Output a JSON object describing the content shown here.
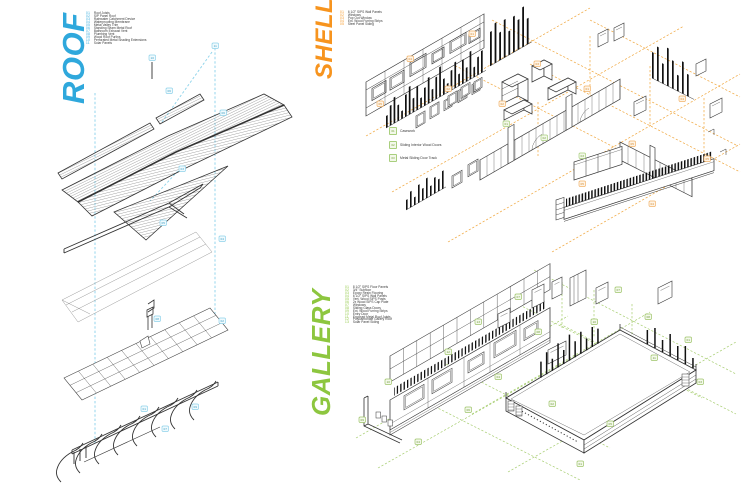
{
  "sections": {
    "roof": {
      "title": "ROOF",
      "legend": [
        {
          "num": "01",
          "label": "Roof Joists"
        },
        {
          "num": "02",
          "label": "SIP Panel Roof"
        },
        {
          "num": "03",
          "label": "Rainwater Catchment Device"
        },
        {
          "num": "04",
          "label": "Waterproofing Membrane"
        },
        {
          "num": "05",
          "label": "Metal Valley Trim"
        },
        {
          "num": "06",
          "label": "Standing Seam Metal Roof"
        },
        {
          "num": "07",
          "label": "Bathroom Exhaust Vent"
        },
        {
          "num": "08",
          "label": "Plumbing Vent"
        },
        {
          "num": "09",
          "label": "Wood Roof Purlins"
        },
        {
          "num": "10",
          "label": "Perforated Metal Shading Extensions"
        },
        {
          "num": "11",
          "label": "Solar Panels"
        }
      ]
    },
    "shell": {
      "title": "SHELL",
      "legend": [
        {
          "num": "01",
          "label": "6 1/2\" SIPS Wall Panels"
        },
        {
          "num": "02",
          "label": "Windows"
        },
        {
          "num": "03",
          "label": "Pop Out Window"
        },
        {
          "num": "04",
          "label": "Ext. Wood Furring Strips"
        },
        {
          "num": "05",
          "label": "Steel Panel Siding"
        }
      ],
      "sub_legend": [
        {
          "num": "01",
          "label": "Casework"
        },
        {
          "num": "02",
          "label": "Sliding Interior Wood Doors"
        },
        {
          "num": "03",
          "label": "Metal Sliding Door Track"
        }
      ]
    },
    "gallery": {
      "title": "GALLERY",
      "legend": [
        {
          "num": "01",
          "label": "8 1/2\" SIPS Floor Panels"
        },
        {
          "num": "02",
          "label": "3/4\" Subfloor"
        },
        {
          "num": "03",
          "label": "Epoxy Resin Flooring"
        },
        {
          "num": "04",
          "label": "6 1/2\" SIPS Wall Panels"
        },
        {
          "num": "05",
          "label": "Vert. Wood SIPS Posts"
        },
        {
          "num": "06",
          "label": "2x Wood SIPS Cap Plate"
        },
        {
          "num": "07",
          "label": "Windows"
        },
        {
          "num": "08",
          "label": "Sliding Glass Doors"
        },
        {
          "num": "09",
          "label": "Ext. Wood Furring Strips"
        },
        {
          "num": "10",
          "label": "Entry Door"
        },
        {
          "num": "11",
          "label": "Exposed Metal Roof Joists"
        },
        {
          "num": "12",
          "label": "Polycarbonate Gallery Roof"
        },
        {
          "num": "13",
          "label": "Solar Panel Siding"
        }
      ]
    }
  },
  "colors": {
    "roof_accent": "#2FA8DC",
    "shell_accent": "#F7941E",
    "gallery_accent": "#8DC63F",
    "ink": "#3A3A3A",
    "line": "#333333",
    "roof_dash": "#8AD2EA",
    "shell_dash": "#F0A63C",
    "gallery_dash": "#A6CD6F",
    "roof_callout": {
      "stroke": "#8FD2EA",
      "fill": "#F0FAFD",
      "text": "#3F9EC4"
    },
    "shell_callout": {
      "stroke": "#F2B36A",
      "fill": "#FDF4E7",
      "text": "#D9892B"
    },
    "shell_callout_green": {
      "stroke": "#A9CF7E",
      "fill": "#F3F8EA",
      "text": "#76A23E"
    },
    "gallery_callout": {
      "stroke": "#9EC46A",
      "fill": "#F4F9EC",
      "text": "#719A3C"
    }
  },
  "callouts": {
    "roof": [
      {
        "x": 99,
        "y": 17,
        "num": "10"
      },
      {
        "x": 162,
        "y": 5,
        "num": "11"
      },
      {
        "x": 116,
        "y": 50,
        "num": "06"
      },
      {
        "x": 170,
        "y": 72,
        "num": "06"
      },
      {
        "x": 129,
        "y": 128,
        "num": "03"
      },
      {
        "x": 110,
        "y": 182,
        "num": "05"
      },
      {
        "x": 169,
        "y": 198,
        "num": "04"
      },
      {
        "x": 104,
        "y": 278,
        "num": "08"
      },
      {
        "x": 169,
        "y": 280,
        "num": "02"
      },
      {
        "x": 91,
        "y": 368,
        "num": "01"
      },
      {
        "x": 142,
        "y": 366,
        "num": "09"
      },
      {
        "x": 112,
        "y": 388,
        "num": "07"
      }
    ],
    "shell": [
      {
        "x": 117,
        "y": 27,
        "num": "01"
      },
      {
        "x": 55,
        "y": 52,
        "num": "04"
      },
      {
        "x": 93,
        "y": 82,
        "num": "02"
      },
      {
        "x": 25,
        "y": 97,
        "num": "05"
      },
      {
        "x": 147,
        "y": 97,
        "num": "02"
      },
      {
        "x": 182,
        "y": 57,
        "num": "03"
      },
      {
        "x": 232,
        "y": 82,
        "num": "01"
      },
      {
        "x": 277,
        "y": 137,
        "num": "05"
      },
      {
        "x": 327,
        "y": 92,
        "num": "04"
      },
      {
        "x": 352,
        "y": 152,
        "num": "05"
      },
      {
        "x": 297,
        "y": 197,
        "num": "04"
      },
      {
        "x": 227,
        "y": 177,
        "num": "05"
      },
      {
        "x": 151,
        "y": 117,
        "num": "01",
        "g": true
      },
      {
        "x": 189,
        "y": 131,
        "num": "02",
        "g": true
      },
      {
        "x": 227,
        "y": 149,
        "num": "03",
        "g": true
      }
    ],
    "gallery": [
      {
        "x": 37,
        "y": 117,
        "num": "10"
      },
      {
        "x": 11,
        "y": 155,
        "num": "09"
      },
      {
        "x": 67,
        "y": 177,
        "num": "04"
      },
      {
        "x": 97,
        "y": 87,
        "num": "12"
      },
      {
        "x": 127,
        "y": 57,
        "num": "13"
      },
      {
        "x": 147,
        "y": 112,
        "num": "04"
      },
      {
        "x": 167,
        "y": 32,
        "num": "07"
      },
      {
        "x": 187,
        "y": 67,
        "num": "08"
      },
      {
        "x": 201,
        "y": 139,
        "num": "02"
      },
      {
        "x": 243,
        "y": 57,
        "num": "10"
      },
      {
        "x": 267,
        "y": 25,
        "num": "07"
      },
      {
        "x": 297,
        "y": 52,
        "num": "08"
      },
      {
        "x": 337,
        "y": 75,
        "num": "01"
      },
      {
        "x": 349,
        "y": 117,
        "num": "03"
      },
      {
        "x": 229,
        "y": 199,
        "num": "01"
      },
      {
        "x": 259,
        "y": 159,
        "num": "05"
      },
      {
        "x": 117,
        "y": 145,
        "num": "06"
      },
      {
        "x": 303,
        "y": 93,
        "num": "11"
      }
    ]
  }
}
